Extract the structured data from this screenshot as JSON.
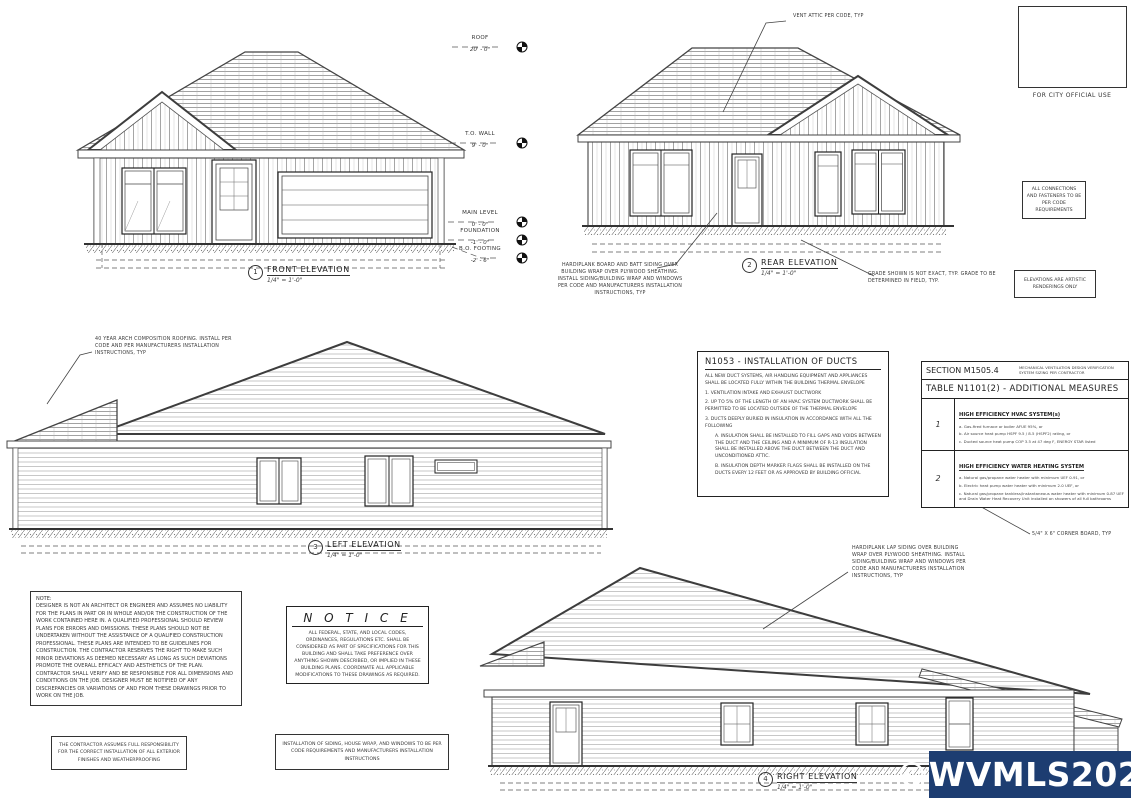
{
  "views": {
    "front": {
      "num": "1",
      "title": "FRONT ELEVATION",
      "scale": "1/4\" = 1'-0\""
    },
    "rear": {
      "num": "2",
      "title": "REAR ELEVATION",
      "scale": "1/4\" = 1'-0\""
    },
    "left": {
      "num": "3",
      "title": "LEFT ELEVATION",
      "scale": "1/4\" = 1'-0\""
    },
    "right": {
      "num": "4",
      "title": "RIGHT ELEVATION",
      "scale": "1/4\" = 1'-0\""
    }
  },
  "datums": [
    {
      "label": "ROOF",
      "value": "20' - 0\""
    },
    {
      "label": "T.O. WALL",
      "value": "9' - 0\""
    },
    {
      "label": "MAIN LEVEL",
      "value": "0' - 0\""
    },
    {
      "label": "FOUNDATION",
      "value": "-1' - 0\""
    },
    {
      "label": "B.O. FOOTING",
      "value": "-2' - 6\""
    }
  ],
  "annotations": {
    "vent_attic": "VENT ATTIC PER CODE, TYP",
    "siding_batt": "HARDIPLANK BOARD AND BATT SIDING OVER BUILDING WRAP OVER PLYWOOD SHEATHING. INSTALL SIDING/BUILDING WRAP AND WINDOWS PER CODE AND MANUFACTURERS INSTALLATION INSTRUCTIONS, TYP",
    "grade_note": "GRADE SHOWN IS NOT EXACT, TYP. GRADE TO BE DETERMINED IN FIELD, TYP.",
    "roofing_note": "40 YEAR ARCH COMPOSITION ROOFING. INSTALL PER CODE AND PER MANUFACTURERS INSTALLATION INSTRUCTIONS, TYP",
    "corner_board": "5/4\" X 6\" CORNER BOARD, TYP",
    "siding_lap": "HARDIPLANK LAP SIDING OVER BUILDING WRAP OVER PLYWOOD SHEATHING. INSTALL SIDING/BUILDING WRAP AND WINDOWS PER CODE AND MANUFACTURERS INSTALLATION INSTRUCTIONS, TYP"
  },
  "side_boxes": {
    "for_city": "FOR CITY OFFICIAL USE",
    "connections": "ALL CONNECTIONS AND FASTENERS TO BE PER CODE REQUIREMENTS",
    "artistic": "ELEVATIONS ARE ARTISTIC RENDERINGS ONLY"
  },
  "ducts": {
    "title": "N1053 - INSTALLATION OF DUCTS",
    "paragraphs": [
      "ALL NEW DUCT SYSTEMS, AIR HANDLING EQUIPMENT AND APPLIANCES SHALL BE LOCATED FULLY WITHIN THE BUILDING THERMAL ENVELOPE",
      "1. VENTILATION INTAKE AND EXHAUST DUCTWORK",
      "2. UP TO 5% OF THE LENGTH OF AN HVAC SYSTEM DUCTWORK SHALL BE PERMITTED TO BE LOCATED OUTSIDE OF THE THERMAL ENVELOPE",
      "3. DUCTS DEEPLY BURIED IN INSULATION IN ACCORDANCE WITH ALL THE FOLLOWING",
      "A. INSULATION SHALL BE INSTALLED TO FILL GAPS AND VOIDS BETWEEN THE DUCT AND THE CEILING AND A MINIMUM OF R-13 INSULATION SHALL BE INSTALLED ABOVE THE DUCT BETWEEN THE DUCT AND UNCONDITIONED ATTIC.",
      "B. INSULATION DEPTH MARKER FLAGS SHALL BE INSTALLED ON THE DUCTS EVERY 12 FEET OR AS APPROVED BY BUILDING OFFICIAL"
    ]
  },
  "table": {
    "section": "SECTION M1505.4",
    "section_note": "MECHANICAL VENTILATION DESIGN VERIFICATION SYSTEM SIZING PER CONTRACTOR",
    "title": "TABLE N1101(2) - ADDITIONAL MEASURES",
    "rows": [
      {
        "num": "1",
        "header": "HIGH EFFICIENCY HVAC SYSTEM(s)",
        "items": [
          "a. Gas-fired furnace or boiler AFUE 95%, or",
          "b. Air source heat pump HSPF 9.5 / 8.5 (HSPF2) rating, or",
          "c. Ducted source heat pump COP 3.5 at 47 deg F, ENERGY STAR listed"
        ]
      },
      {
        "num": "2",
        "header": "HIGH EFFICIENCY WATER HEATING SYSTEM",
        "items": [
          "a. Natural gas/propane water heater with minimum UEF 0.91, or",
          "b. Electric heat pump water heater with minimum 2.0 UEF, or",
          "c. Natural gas/propane tankless/instantaneous water heater with minimum 0.87 UEF and Drain Water Heat Recovery Unit installed on showers of all full bathrooms"
        ]
      }
    ]
  },
  "note": {
    "title": "NOTE:",
    "body": "DESIGNER IS NOT AN ARCHITECT OR ENGINEER AND ASSUMES NO LIABILITY FOR THE PLANS IN PART OR IN WHOLE AND/OR THE CONSTRUCTION OF THE WORK CONTAINED HERE IN. A QUALIFIED PROFESSIONAL SHOULD REVIEW PLANS FOR ERRORS AND OMISSIONS. THESE PLANS SHOULD NOT BE UNDERTAKEN WITHOUT THE ASSISTANCE OF A QUALIFIED CONSTRUCTION PROFESSIONAL. THESE PLANS ARE INTENDED TO BE GUIDELINES FOR CONSTRUCTION. THE CONTRACTOR RESERVES THE RIGHT TO MAKE SUCH MINOR DEVIATIONS AS DEEMED NECESSARY AS LONG AS SUCH DEVIATIONS PROMOTE THE OVERALL EFFICACY AND AESTHETICS OF THE PLAN. CONTRACTOR SHALL VERIFY AND BE RESPONSIBLE FOR ALL DIMENSIONS AND CONDITIONS ON THE JOB. DESIGNER MUST BE NOTIFIED OF ANY DISCREPANCIES OR VARIATIONS OF AND FROM THESE DRAWINGS PRIOR TO WORK ON THE JOB."
  },
  "notice": {
    "title": "N O T I C E",
    "body": "ALL FEDERAL, STATE, AND LOCAL CODES, ORDINANCES, REGULATIONS ETC. SHALL BE CONSIDERED AS PART OF SPECIFICATIONS FOR THIS BUILDING AND SHALL TAKE PREFERENCE OVER ANYTHING SHOWN DESCRIBED, OR IMPLIED IN THESE BUILDING PLANS. COORDINATE ALL APPLICABLE MODIFICATIONS TO THESE DRAWINGS AS REQUIRED."
  },
  "bottom_boxes": {
    "contractor": "THE CONTRACTOR ASSUMES FULL RESPONSIBILITY FOR THE CORRECT INSTALLATION OF ALL EXTERIOR FINISHES AND WEATHERPROOFING",
    "siding": "INSTALLATION OF SIDING, HOUSE WRAP, AND WINDOWS TO BE PER CODE REQUIREMENTS AND MANUFACTURERS INSTALLATION INSTRUCTIONS"
  },
  "watermark": {
    "text": "©WVMLS2026",
    "color": "#1d3d71"
  }
}
